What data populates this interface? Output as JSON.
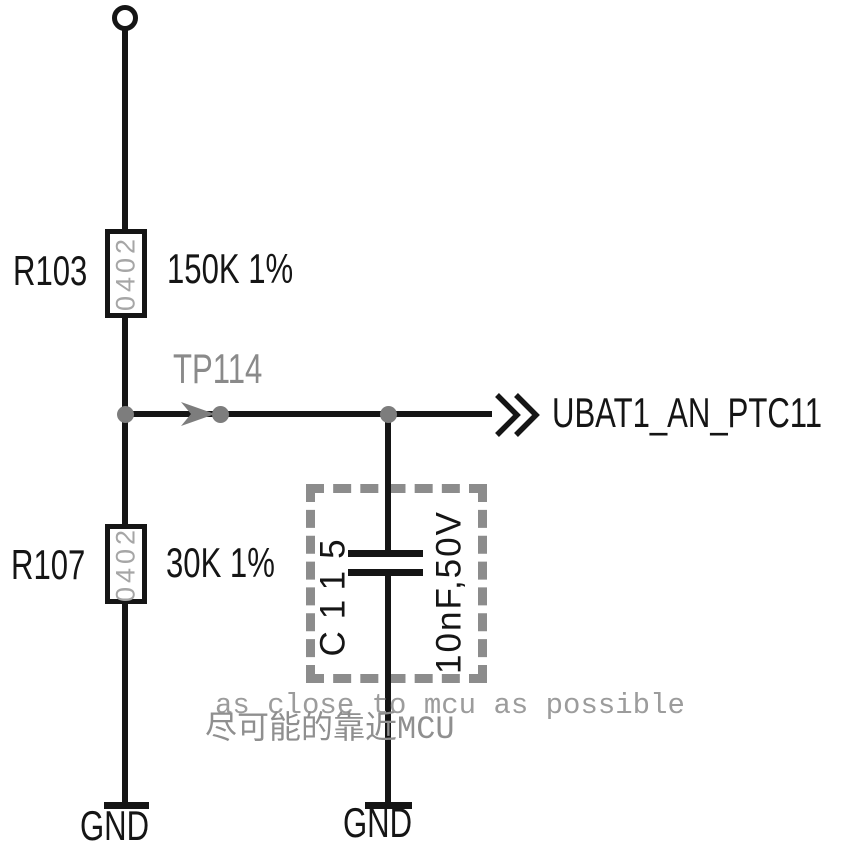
{
  "schematic": {
    "resistors": [
      {
        "ref": "R103",
        "package": "0402",
        "value": "150K 1%"
      },
      {
        "ref": "R107",
        "package": "0402",
        "value": "30K 1%"
      }
    ],
    "capacitor": {
      "ref": "C115",
      "value": "10nF,50V"
    },
    "testpoint": {
      "ref": "TP114"
    },
    "net": {
      "label": "UBAT1_AN_PTC11"
    },
    "ground": {
      "label": "GND"
    },
    "notes": {
      "en": "as close to mcu as possible",
      "zh": "尽可能的靠近MCU"
    },
    "colors": {
      "wire": "#151515",
      "annotation_gray": "#8a8a8a",
      "package_text": "#a6a6a6",
      "note_gray": "#9c9c9c",
      "background": "#ffffff"
    }
  }
}
